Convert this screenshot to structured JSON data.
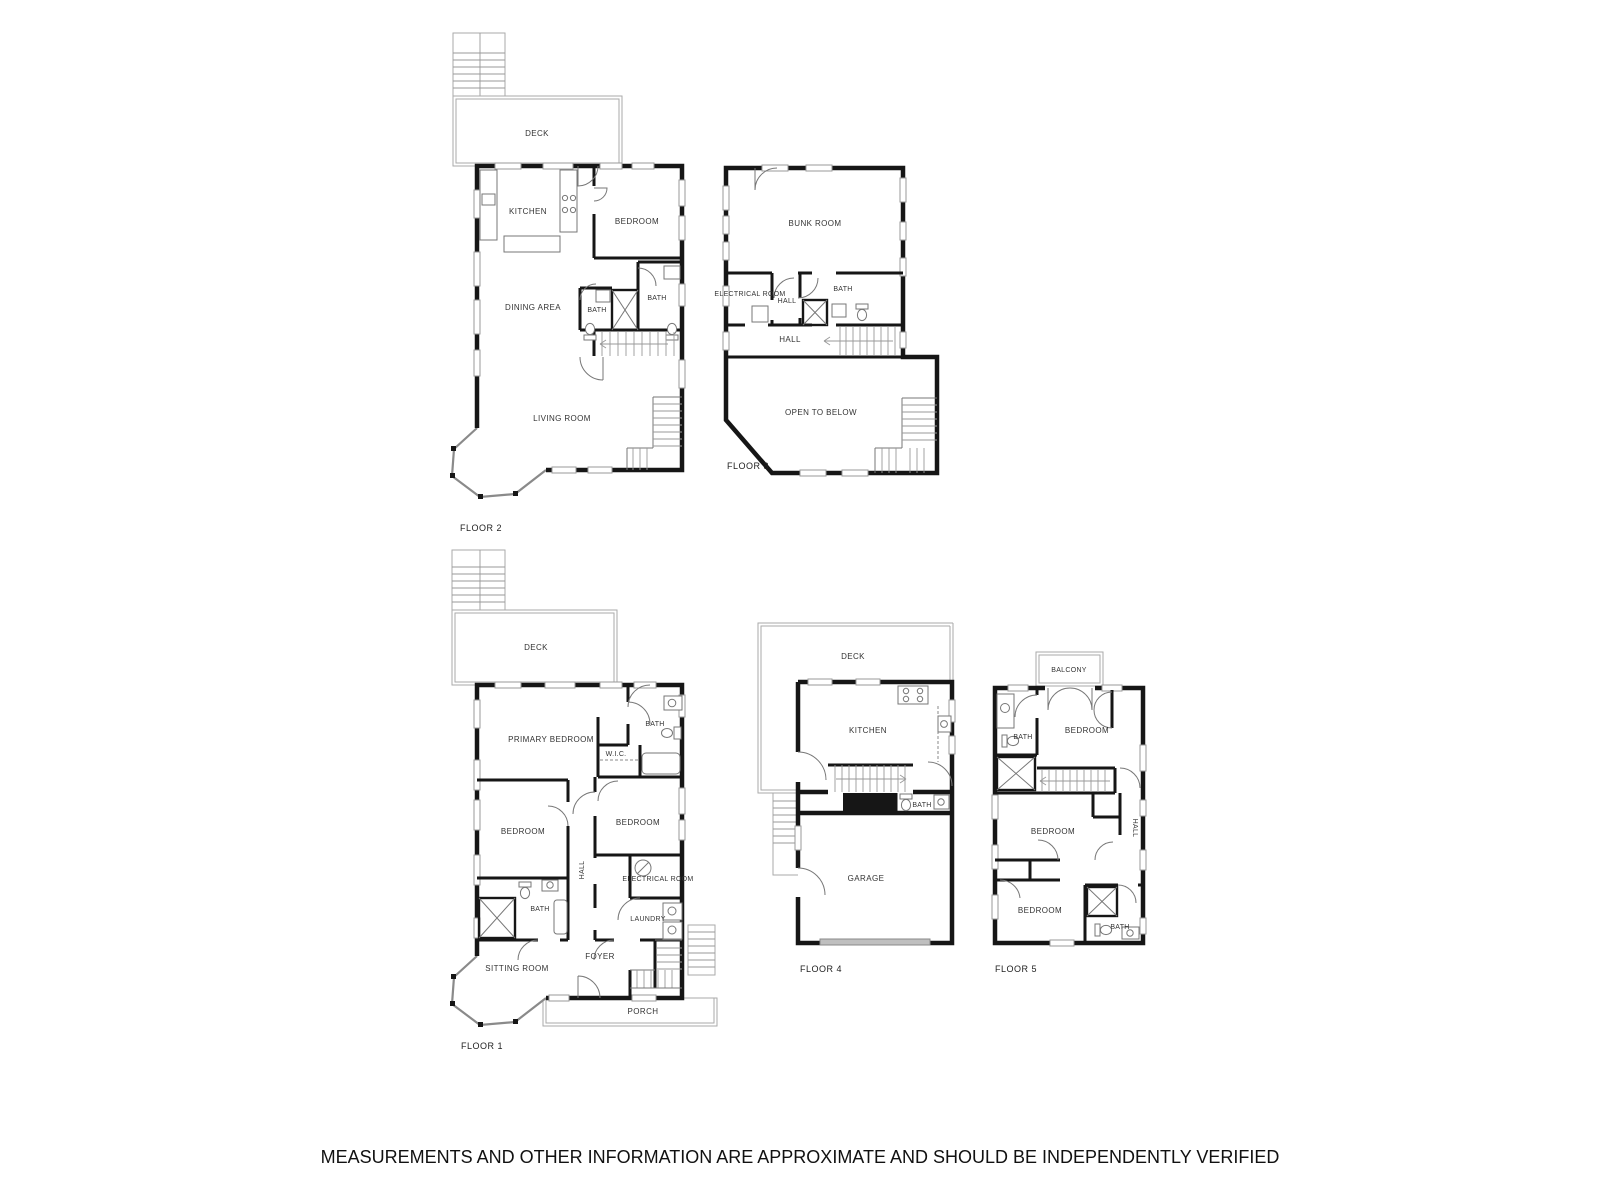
{
  "disclaimer": "MEASUREMENTS AND OTHER INFORMATION ARE APPROXIMATE AND SHOULD BE INDEPENDENTLY VERIFIED",
  "floors": [
    {
      "id": "floor-2",
      "label": "FLOOR 2",
      "rooms": {
        "deck": "DECK",
        "kitchen": "KITCHEN",
        "bedroom": "BEDROOM",
        "dining_area": "DINING AREA",
        "bath_left": "BATH",
        "bath_right": "BATH",
        "living_room": "LIVING ROOM"
      }
    },
    {
      "id": "floor-3",
      "label": "FLOOR 3",
      "rooms": {
        "bunk_room": "BUNK ROOM",
        "electrical_room": "ELECTRICAL ROOM",
        "hall_upper": "HALL",
        "bath": "BATH",
        "hall_lower": "HALL",
        "open_to_below": "OPEN TO BELOW"
      }
    },
    {
      "id": "floor-1",
      "label": "FLOOR 1",
      "rooms": {
        "deck": "DECK",
        "primary_bedroom": "PRIMARY BEDROOM",
        "bath_upper": "BATH",
        "wic": "W.I.C.",
        "bedroom_left": "BEDROOM",
        "bedroom_right": "BEDROOM",
        "hall": "HALL",
        "electrical_room": "ELECTRICAL ROOM",
        "bath_lower": "BATH",
        "laundry": "LAUNDRY",
        "foyer": "FOYER",
        "sitting_room": "SITTING ROOM",
        "porch": "PORCH"
      }
    },
    {
      "id": "floor-4",
      "label": "FLOOR 4",
      "rooms": {
        "deck": "DECK",
        "kitchen": "KITCHEN",
        "bath": "BATH",
        "garage": "GARAGE"
      }
    },
    {
      "id": "floor-5",
      "label": "FLOOR 5",
      "rooms": {
        "balcony": "BALCONY",
        "bath_upper": "BATH",
        "bedroom_upper": "BEDROOM",
        "bedroom_middle": "BEDROOM",
        "hall": "HALL",
        "bedroom_lower": "BEDROOM",
        "bath_lower": "BATH"
      }
    }
  ]
}
